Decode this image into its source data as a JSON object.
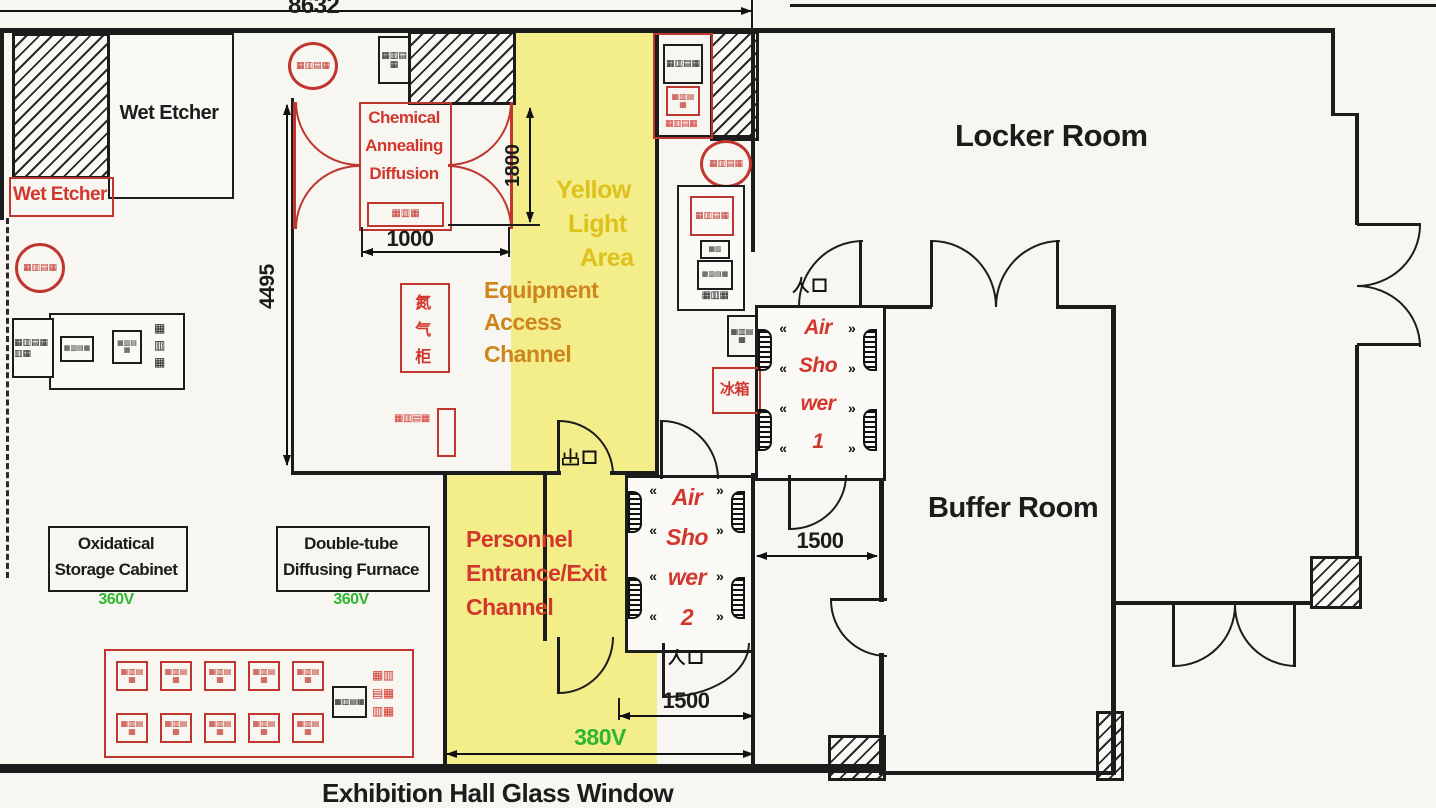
{
  "colors": {
    "red_stamp": "#c0362e",
    "red_text": "#d2372e",
    "yellow_bg": "#f3ee8a",
    "yellow_text": "#dfc11d",
    "orange_text": "#cf851e",
    "green": "#2fb62f",
    "wall": "#1c1c1c"
  },
  "dims": {
    "overall_width": "8632",
    "left_height": "4495",
    "chem_door_width": "1000",
    "chem_height": "1800",
    "corridor_width": "1500",
    "entrance_width": "1500",
    "channel_voltage": "380V"
  },
  "rooms": {
    "locker": "Locker Room",
    "buffer": "Buffer Room",
    "wet_etcher": "Wet Etcher",
    "wet_etcher_red": "Wet Etcher",
    "chemical": {
      "l1": "Chemical",
      "l2": "Annealing",
      "l3": "Diffusion"
    },
    "yellow_area": {
      "l1": "Yellow",
      "l2": "Light",
      "l3": "Area"
    },
    "equipment_channel": {
      "l1": "Equipment",
      "l2": "Access",
      "l3": "Channel"
    },
    "personnel_channel": {
      "l1": "Personnel",
      "l2": "Entrance/Exit",
      "l3": "Channel"
    },
    "air_shower_1": {
      "l1": "Air",
      "l2": "Sho",
      "l3": "wer",
      "l4": "1"
    },
    "air_shower_2": {
      "l1": "Air",
      "l2": "Sho",
      "l3": "wer",
      "l4": "2"
    }
  },
  "equipment": {
    "oxidatical": {
      "l1": "Oxidatical",
      "l2": "Storage Cabinet",
      "voltage": "360V"
    },
    "double_tube": {
      "l1": "Double-tube",
      "l2": "Diffusing Furnace",
      "voltage": "360V"
    },
    "nitrogen_cabinet": {
      "c1": "氮",
      "c2": "气",
      "c3": "柜"
    },
    "refrigerator": "冰箱"
  },
  "labels": {
    "entrance_1": "入口",
    "entrance_2": "入口",
    "exit": "出口",
    "exhibition_window": "Exhibition Hall Glass Window"
  },
  "garble": {
    "g2": "▦▥",
    "g2b": "▤▦",
    "g3": "▦▥▦",
    "g3b": "▤▦▥",
    "g4": "▦▥▤▦",
    "g6": "▦▥▤▦▥▦"
  }
}
